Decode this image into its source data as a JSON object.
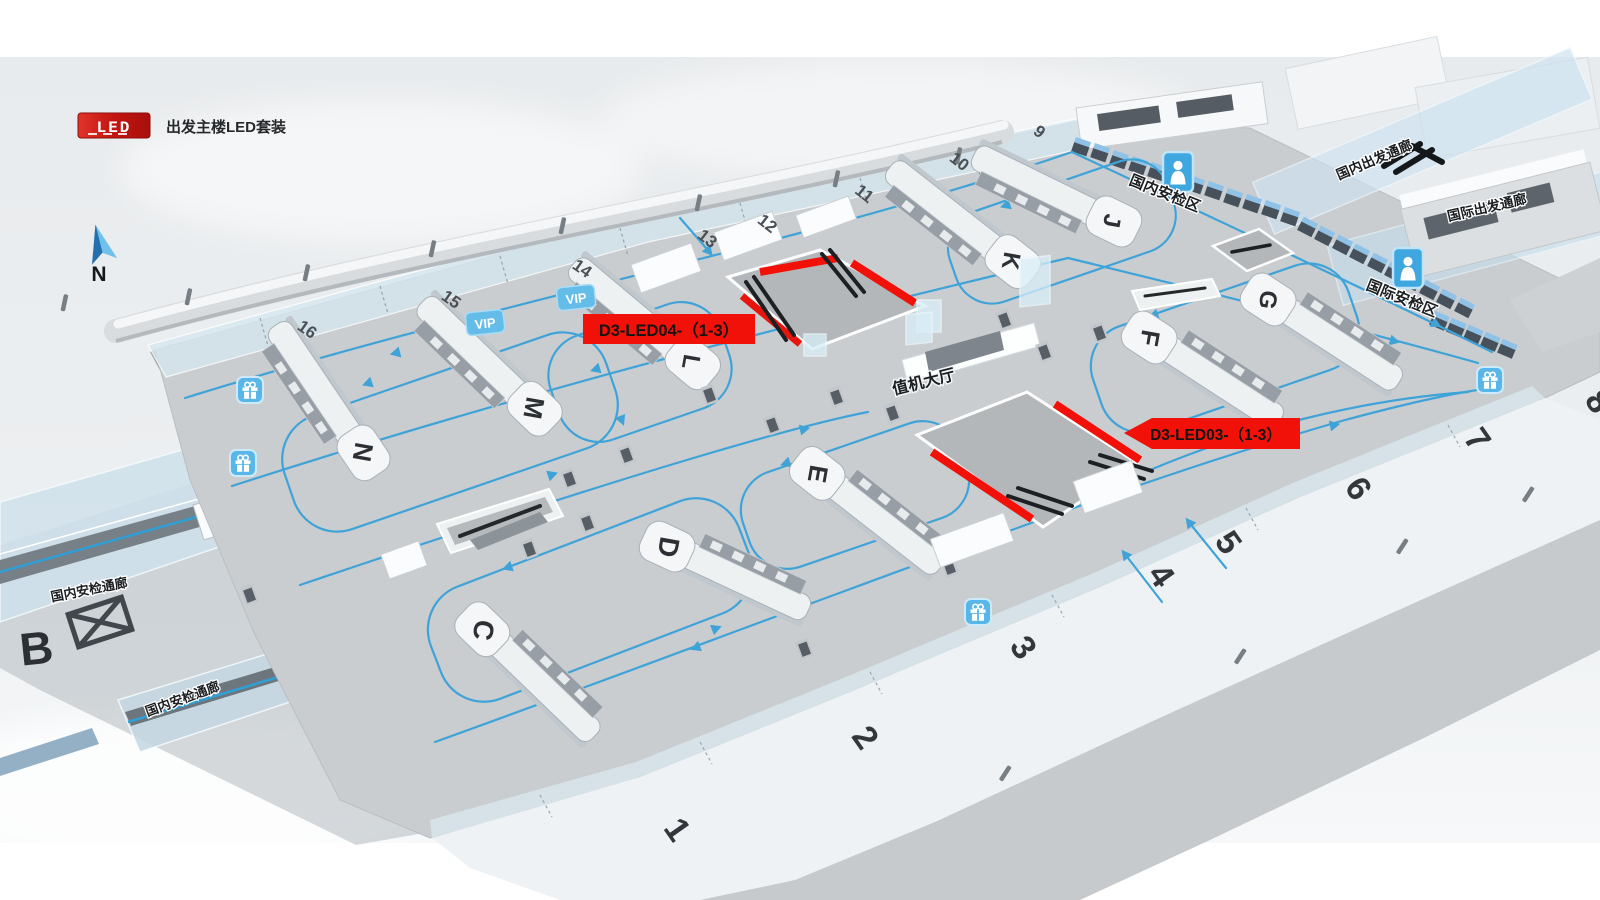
{
  "legend": {
    "badge_text": "LED",
    "title": "出发主楼LED套装"
  },
  "compass": {
    "north_label": "N"
  },
  "led_signs": [
    {
      "id": "D3-LED04",
      "label": "D3-LED04-（1-3）"
    },
    {
      "id": "D3-LED03",
      "label": "D3-LED03-（1-3）"
    }
  ],
  "zone_labels": [
    {
      "text": "国内安检区"
    },
    {
      "text": "国际安检区"
    },
    {
      "text": "国内出发通廊"
    },
    {
      "text": "国际出发通廊"
    },
    {
      "text": "值机大厅"
    },
    {
      "text": "国内安检通廊"
    },
    {
      "text": "国内安检通廊"
    }
  ],
  "island_letters": [
    {
      "letter": "B"
    },
    {
      "letter": "C"
    },
    {
      "letter": "D"
    },
    {
      "letter": "E"
    },
    {
      "letter": "F"
    },
    {
      "letter": "G"
    },
    {
      "letter": "J"
    },
    {
      "letter": "K"
    },
    {
      "letter": "L"
    },
    {
      "letter": "M"
    },
    {
      "letter": "N"
    }
  ],
  "gate_numbers": [
    {
      "label": "1"
    },
    {
      "label": "2"
    },
    {
      "label": "3"
    },
    {
      "label": "4"
    },
    {
      "label": "5"
    },
    {
      "label": "6"
    },
    {
      "label": "7"
    },
    {
      "label": "8"
    },
    {
      "label": "9"
    },
    {
      "label": "10"
    },
    {
      "label": "11"
    },
    {
      "label": "12"
    },
    {
      "label": "13"
    },
    {
      "label": "14"
    },
    {
      "label": "15"
    },
    {
      "label": "16"
    }
  ],
  "vip_badges": [
    {
      "label": "VIP"
    },
    {
      "label": "VIP"
    }
  ],
  "colors": {
    "accent_red": "#f21108",
    "flow_blue": "#3fa3d8",
    "icon_blue": "#58b7e8",
    "floor_gray": "#c9cdd0",
    "text_dark": "#26292c"
  }
}
